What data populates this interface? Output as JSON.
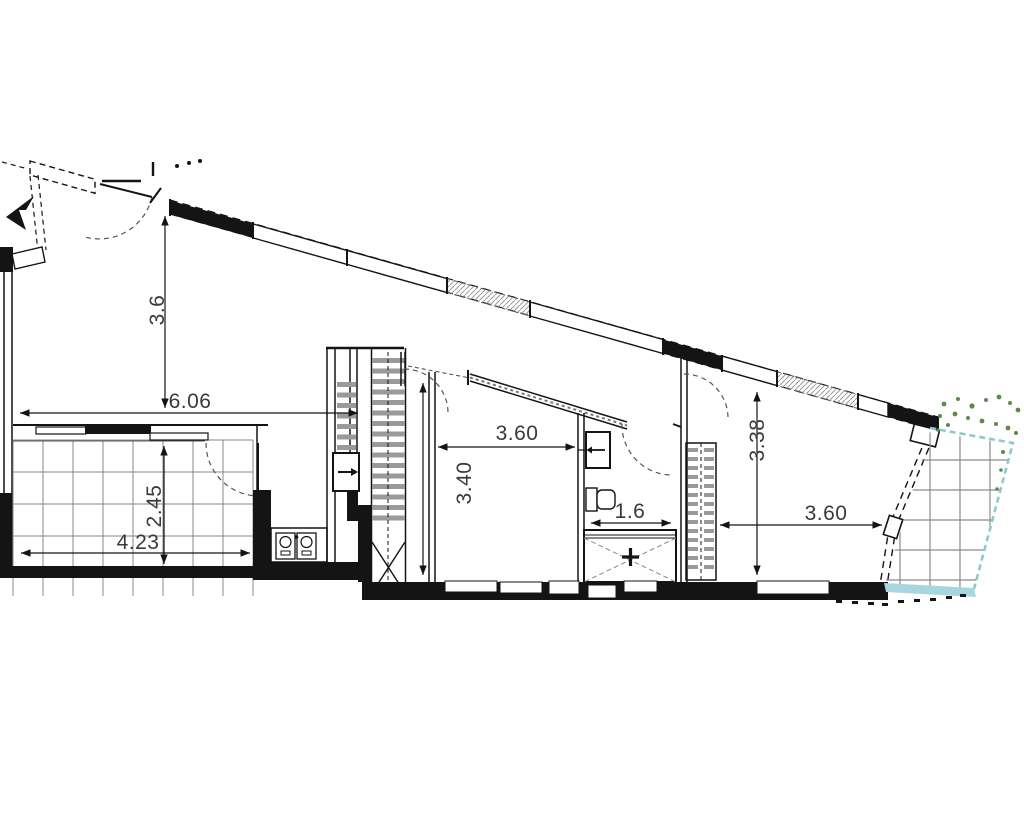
{
  "drawing": {
    "type": "architectural-floor-plan",
    "dimensions": {
      "living_width": "6.06",
      "living_height": "3.6",
      "terrace_left_width": "4.23",
      "terrace_left_height": "2.45",
      "room_mid_width": "3.60",
      "room_mid_height": "3.40",
      "bath_width": "1.6",
      "room_right_height": "3.38",
      "room_right_width": "3.60"
    },
    "colors": {
      "wall": "#141414",
      "grid": "#8a8a8a",
      "stair_tread": "#9a9a9a",
      "terrace_border_teal": "#8fc8d0",
      "terrace_strip_teal": "#a8d6de",
      "vegetation_green": "#5d8a4a",
      "dim_text": "#3a3a3a"
    }
  }
}
